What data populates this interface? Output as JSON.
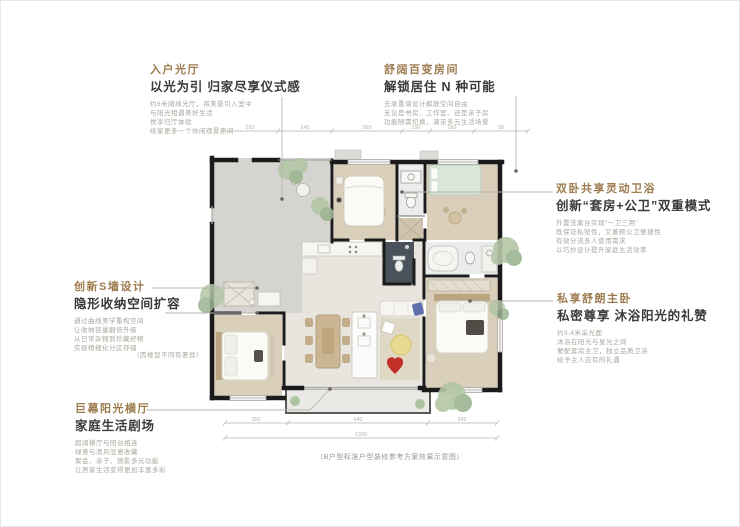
{
  "colors": {
    "accent_title": "#9c7b4e",
    "subtitle_text": "#3a3a3a",
    "body_text": "#aba69d",
    "wall": "#1b1b1b",
    "wood_floor": "#d9cfba",
    "courtyard_floor": "#d6d4d0",
    "greenery": "#b3c6a6",
    "mint_bed": "#d9e6da",
    "red_decor": "#c22f28",
    "yellow_decor": "#e9d88f",
    "blue_decor": "#5f6fae",
    "dark_tile": "#49525a"
  },
  "annotations": {
    "entry_hall": {
      "title": "入户光厅",
      "subtitle": "以光为引 归家尽享仪式感",
      "lines": [
        "约6米阔绰光厅，将美景引入室中",
        "与阳光相遇美好生活",
        "悦享归厅体验",
        "给家更多一个休闲观景空间"
      ]
    },
    "flex_room": {
      "title": "舒阔百变房间",
      "subtitle": "解锁居住 N 种可能",
      "lines": [
        "去承重墙设计解放空间自由",
        "无论是书房、工作室、还是亲子房",
        "功能随需切换，满足多元生活场景"
      ]
    },
    "shared_bath": {
      "title": "双卧共享灵动卫浴",
      "subtitle": "创新“套房+公卫”双重模式",
      "lines": [
        "外置洗漱台实现“一卫三用”",
        "既保证私密性，又兼顾公卫便捷性",
        "有效分流多人使用需求",
        "以巧妙设计提升家庭生活效率"
      ]
    },
    "master_bedroom": {
      "title": "私享舒朗主卧",
      "subtitle": "私密尊享 沐浴阳光的礼赞",
      "lines": [
        "约3.4米采光面",
        "沐浴在阳光与星光之间",
        "奢配套房主卫，独立品质卫浴",
        "给予主人应有的礼遇"
      ]
    },
    "s_wall": {
      "title": "创新S墙设计",
      "subtitle": "隐形收纳空间扩容",
      "lines": [
        "通过曲线美学重构空间",
        "让收纳容量翻倍升级",
        "从日常杂物到珍藏好物",
        "实现精细化分区存储"
      ],
      "note": "（因楼型不同有差异）"
    },
    "sun_hall": {
      "title": "巨幕阳光横厅",
      "subtitle": "家庭生活剧场",
      "lines": [
        "超阔横厅与阳台相连",
        "绿意与清风恣意收藏",
        "聚会、亲子、观影多元功能",
        "让居家生活变得更加丰富多彩"
      ]
    }
  },
  "plan": {
    "caption": "（B户型标准户型装修参考方案效果示意图）",
    "dimensions": {
      "top": [
        "283",
        "245",
        "365",
        "190",
        "283",
        "88"
      ],
      "bottom": [
        "355",
        "640",
        "345"
      ],
      "bottom_total": "1390"
    }
  }
}
